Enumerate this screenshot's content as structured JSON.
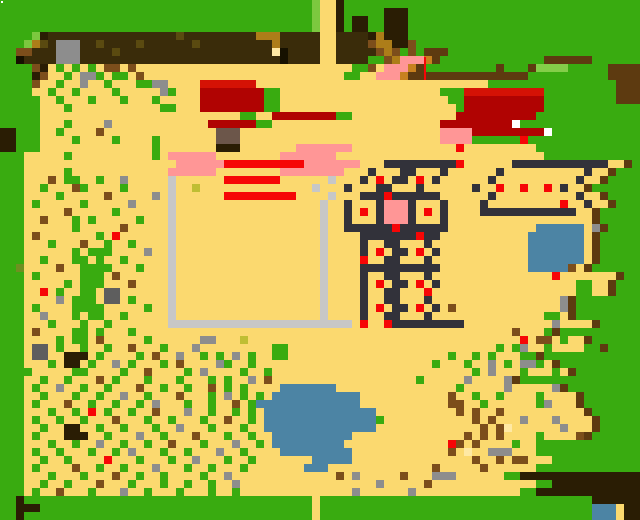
{
  "map": {
    "description": "pixel-art overhead game map",
    "cell_size": 8,
    "grid_cols": 80,
    "grid_rows": 65,
    "palette": {
      ".": {
        "name": "sand",
        "color": "#FBD96F"
      },
      "G": {
        "name": "grass",
        "color": "#39AB10"
      },
      "g": {
        "name": "grass-light",
        "color": "#7CC83F"
      },
      "h": {
        "name": "bush-light",
        "color": "#84CE49"
      },
      "D": {
        "name": "dark-soil",
        "color": "#3A2C0A"
      },
      "K": {
        "name": "structure-slate",
        "color": "#32323A"
      },
      "R": {
        "name": "red-bright",
        "color": "#F60606"
      },
      "M": {
        "name": "building-red",
        "color": "#B00302"
      },
      "m": {
        "name": "building-red-roof",
        "color": "#D51205"
      },
      "P": {
        "name": "pink",
        "color": "#FF9696"
      },
      "W": {
        "name": "white-door",
        "color": "#FFFFFF"
      },
      "C": {
        "name": "fence-lightgray",
        "color": "#C7C7C7"
      },
      "S": {
        "name": "stone-gray",
        "color": "#8D8D8D"
      },
      "s": {
        "name": "stone-darkgray",
        "color": "#5E5E5E"
      },
      "u": {
        "name": "post-graybrown",
        "color": "#6C564A"
      },
      "E": {
        "name": "log-darkbrown",
        "color": "#2A1D04"
      },
      "B": {
        "name": "debris-brown",
        "color": "#7C4E1B"
      },
      "L": {
        "name": "debris-golden",
        "color": "#AD7D19"
      },
      "O": {
        "name": "crate-orange",
        "color": "#C8811F"
      },
      "o": {
        "name": "moss-olive",
        "color": "#6F9021"
      },
      "d": {
        "name": "soil-speck",
        "color": "#5A4A10"
      },
      "p": {
        "name": "pale-yellow",
        "color": "#FFE9A4"
      },
      "y": {
        "name": "seed-oliveyellow",
        "color": "#BFBE33"
      },
      "A": {
        "name": "water",
        "color": "#4C84A4"
      },
      "k": {
        "name": "black",
        "color": "#161100"
      },
      "b": {
        "name": "fence-brown",
        "color": "#5D3A10"
      }
    },
    "rows": [
      "GGGGGGGGGGGGGGGGGGGGGGGGGGGGGGGGGGGGGGGg..EGGGGGGGGGGGGGGGGGGGGGGGGGGGGGGGGGGGG",
      "GGGGGGGGGGGGGGGGGGGGGGGGGGGGGGGGGGGGGGGg..EGGGGGEEEGGGGGGGGGGGGGGGGGGGGGGGGGGGG",
      "GGGGGGGGGGGGGGGGGGGGGGGGGGGGGGGGGGGGGGGg..EGEEGGEEEGGGGGGGGGGGGGGGGGGGGGGGGGGGG",
      "GGGGGGGGGGGGGGGGGGGGGGGGGGGGGGGGGGGGGGGg..EGEEGGEEEGGGGGGGGGGGGGGGGGGGGGGGGGGGG",
      "GGGGgEDDDDDDDDDDDDDDDDdDDDDDDDDDLLLDDDDD..DDDDELEEEGGGGGGGGGGGGGGGGGGGGGGGGGGGG",
      "GGGgLdDSSSDDdDDDDdDDDDDDdDDDDDDDDDLDDDDD..DDDDBLLEEBGGGGGGGGGGGGGGGGGGGGGGGGGGG",
      "GGBBDDDSSSDDDDdDDDDDDDDDDDDDDDDDDDpkDDDD..DDDDDBLBGBGbbbGGGGGGGGGGGGGGGGGGGGGGG",
      "GGkDDDDSSSDDDDDDDDDDDDDDDDDDDDDDDDDkDDDD..DDDDGGBLPPPObGGGGGGGGGGGGGbbbbbbGGGGG",
      "GGGGBE.G.G.G.BB.B...........................GGB.PPPObGGGGGGGGGbGGGbhhhhGGGGGbb",
      "GGGGEB..G.SSG.GG.B.........................GG..PPPObbbbbbbbbbbbbbbGGGGGGGGGGbb",
      "GGGGB..G..S..G...GGSS....mmmmmmm.............................GGGGGGGGGGGGGGGGbb",
      "GGGG..G..G....G.....SG...MMMMMMMMGG....................GGGmmmmmmmmmmGGGGGGGGGbb",
      "GGGGG..G...G...G...G.....MMMMMMMMGG.....................GGMMMMMMMMMMGGGGGGGGGbb",
      "GGGGG...G...........GG...MMMMMMMMGG......................GMMMMMMMMMMGGGGGGGGGGG",
      "GGGGG.........................GG..MMMMMMMMGG.............MMMMMMMMMMGGGGGGGGGGG",
      "GGGGG...G....S............MMMMMMGG.....................MMMMMMMMMWGGGGGGGGGGGG",
      "EEGGG..G....B..............uuu.........................PPPPMMMMMMMMMWGGGGGGGGGG",
      "EEGGG....G....G....G.......uuu.........................PPPPGGGGGGRGGGGGGGGGGGGG",
      "EEGGG..............G.......EEE.......PPPPPPP.............R.........GGGGGGGGGGG",
      "GGG.....G..........G.PPPPPP........PPPPPPP..........................GGGGGGGGGGG",
      "GGG...................PPPPPPRRRRRRRRRRPPPPPPP...KKKKKKKKKR......KKKKKKKKKKKK..bGG",
      "GGG.....G............PPPPPP........PPPPPPPP...K...KK...K......K..........K..bGG",
      "GGG...B.GG..G..S.....C......RRRRRRR......C...K.R.KK.R.K......K..........K..bGG",
      "GGG..G...BG....G.....C..y..............C...K...KK...K......K..R..R..R.K..bGG",
      "GGG....G.....B.....S.C......RRRRRRRRR....C...KKKRKKKKKK......K..........K..bGG",
      "GGG.G.....G.....S....C..................C..K...KPPPK...K....K.........R..K..bGG",
      "GGG.....B.....G......C..................C..K.R.KPPPK.R.K....KKKKKKKKKKKK..bGG",
      "GGG..B...G.G.....G...C..................C..K...KPPPK...K..................bGG",
      "GGG......G.....B.....C..................C..KKKKKKRKKKKKK...........AAAAAA.SbGG",
      "GGG.B.......G.R......C..................C....KKKKKKKRKK...........AAAAAAA.bGG",
      "GGG...G...B..G..G....C..................C....K..KK...K............AAAAAAA.bGG",
      "GGG......G.GGG....S..C..................C....K.R.KK.R.K...........AAAAAAA.bGG",
      "GGG..G...GG.G..G.....C..................C....R..KK...K............AAAAAAA.bGG",
      "GGo....B..GGGG...G...C..................C....KKKKKKKKKK...........AAAAAB.bGG",
      "GGG.G.....GGG.B......C..................C....K..KK...K...............R.......bGG",
      "GGG.....G.GGG...B....C..................C....K.R.KK.R.K.................GG..bGG",
      "GGG..R.G..GG.ss......C..................C....K..KK...R..................GG..bGG",
      "GGG....S.GGG.ss.G....C..................C....K..KK...K................SbGG",
      "GGG.G....GGGG.....G..C..................C....K.R.KK.R.K.B.............SbGG",
      "GGG..S...G.GG..G.....C..................C....K..KK...K..............GG.bGG",
      "GGG...G...G..G.......CCCCCCCCCCCCCCCCCCCCCCC.R..RKKKKKKKKK...........S....bGG",
      "GGG.B....GG.G...G...............................................B...GbGG",
      "GGG....G.GG.B.....G......SS...y..................................R.BB.G..bGG",
      "GGG.ss.G..G..G..B...G...S.........GG..........................G.GS..G....GGbGG",
      "GGG.ss..EEE.G....G.B..S..G.G.S.G..GG....................G..G.G...GGbGG",
      "GGG...G.EE.G..S.G...G.B....SG..G......................G...G..S.G.SSG.bGG",
      "GGGG.....GG....G..B....G.S....G..G.........................G.S...G...G.bGG",
      "GGG..G..G...B.G...G...G...G.G..S.B..................G.....S....SbGG",
      "GGG.G..S..G..G...B..G..G..B.G.G....AAAAAAA...............G.....S.....SbGG",
      "GGG..G...G..G..S..G...B...G.S.G.G.AAAAAAAAAAA...........B..G..G....G....bGG",
      "GGG.G...B..G..G..G.S...G..G..B.GAAAAAAAAAAAAA...........BB..G......GS...bGG",
      "GGG...G..G.R.G..G..B...S..G..G.G.AAAAAAAAAAAAAA..........B.B..B..........bGG",
      "GGG.G..G..G...B...G..G...G..B..G.AAAAAAAAAAAAAAG...........B.B...S...S....bGG",
      "GGG..G..EE..G..G...G..S...G...G..AAAAAAAAAAAAAA.............B.Bp......S...bGG",
      "GGG.G...EEE..G...S..G...B...G..G..AAAAAAAAAA..............B.B.B....G....BbGG",
      "GGG...G..G..S..G..G..B...G...S..G.AAAAAAAAA.............RB.B....G..GGGGGGG",
      "GGG.G..G...G..G.S...G..G...S..G....AAAAAAAAA............B.p..SSS...GGGGGGG",
      "GGG..G..G....R...G...G..S...G..G.......AAAAA...............B..B.BB...GGGGGGG",
      "GGG.G....B..G..G...S...G..G...G.......AAA.............B.....B......GGGGGGG",
      "GGG...G...G...B..G..G....G..S.............B.S.....B...SSS......GGEEEEE",
      "GGG..G..G...B...G...G..G..G..S.................S.....B.............GGEEEEE",
      "GGG.G..B...G...S..G...G...G..G..............S......S.............GGEEEEE",
      "GGEGGGGGGGGGGGGGGGGGGGGGGGGGGGGGGGGGGGG.GGGGGGGGGGGGGGGGGGGGGGGGGGGGGGGGGGEEEEE",
      "GGEEEGGGGGGGGGGGGGGGGGGGGGGGGGGGGGGGGGG.GGGGGGGGGGGGGGGGGGGGGGGGGGGGGGGGGGAAA.E",
      "GGEGGGGGGGGGGGGGGGGGGGGGGGGGGGGGGGGGGGG.GGGGGGGGGGGGGGGGGGGGGGGGGGGGGGGGGGAAA.E"
    ],
    "overlays": [
      {
        "name": "white-dot",
        "x": 1,
        "y": 1,
        "w": 2,
        "h": 2,
        "color": "#FFFFFF"
      },
      {
        "name": "red-sliver",
        "x": 424,
        "y": 57,
        "w": 2,
        "h": 23,
        "color": "#F60606"
      }
    ]
  }
}
